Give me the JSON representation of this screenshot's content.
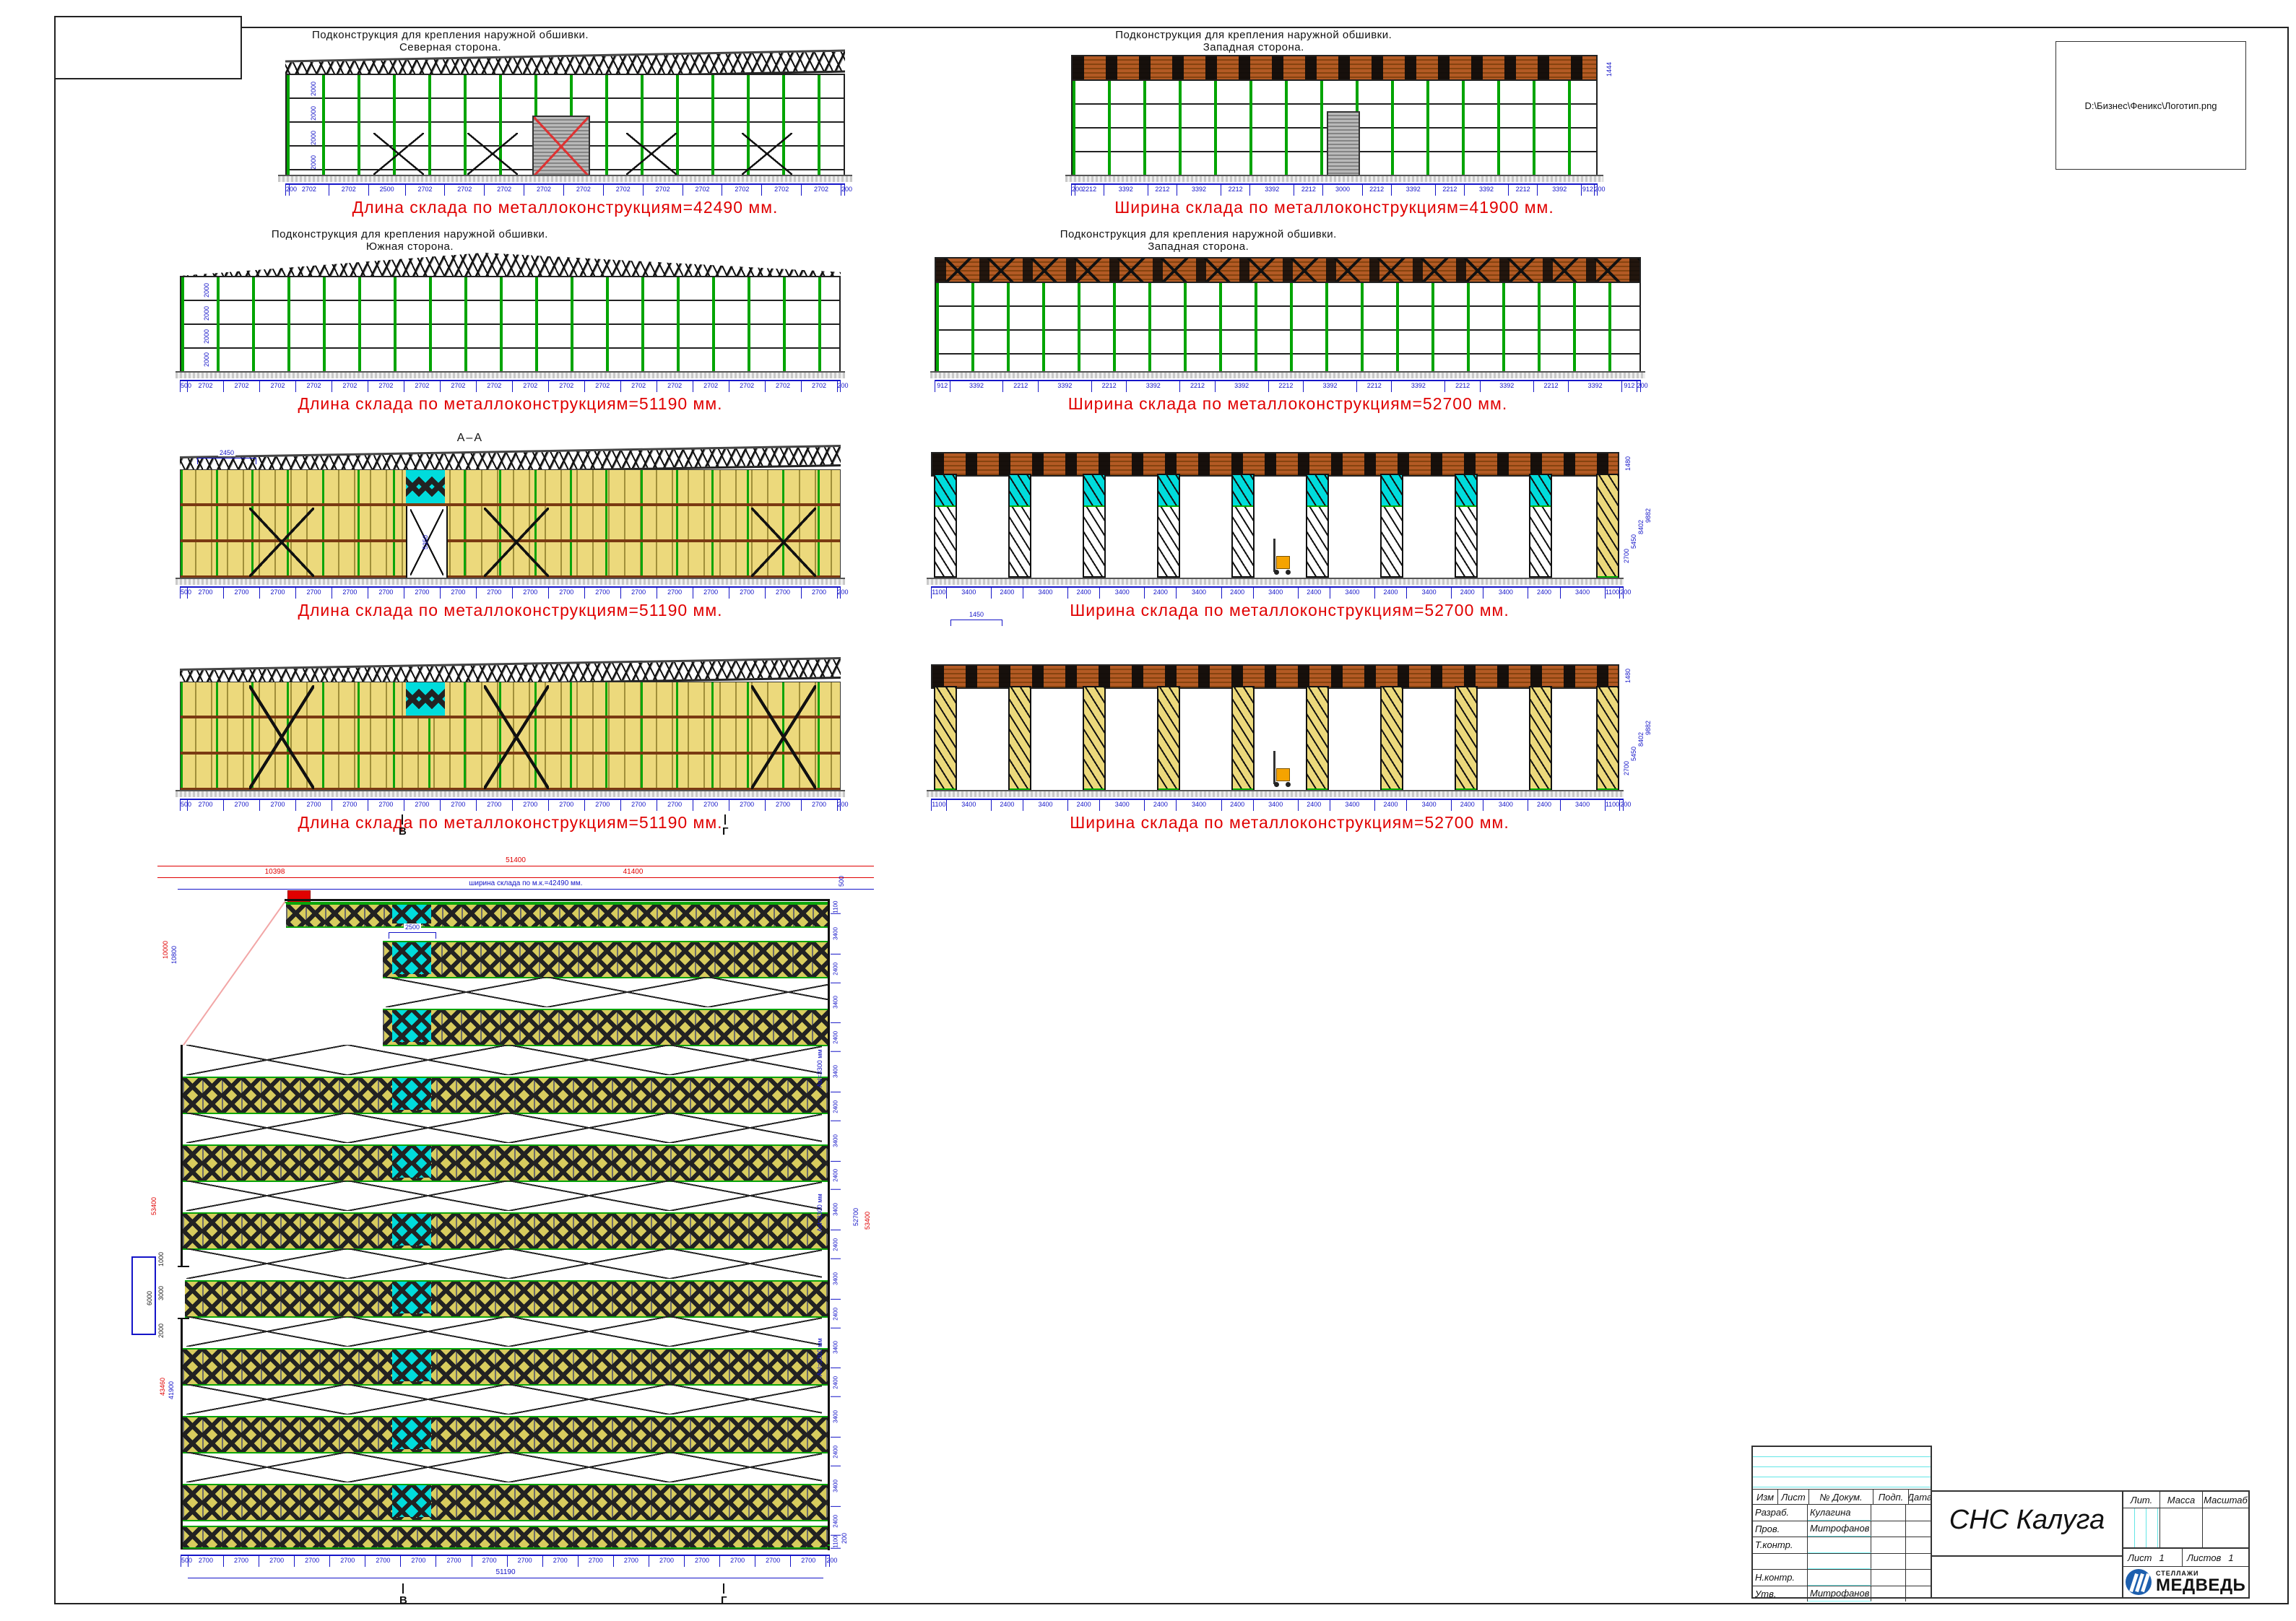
{
  "sheet": {
    "logo_path_label": "D:\\Бизнес\\Феникс\\Логотип.png"
  },
  "views": {
    "north": {
      "title1": "Подконструкция для крепления наружной обшивки.",
      "title2": "Северная сторона.",
      "total_text": "Длина склада по металлоконструкциям=42490 мм.",
      "dims": [
        "200",
        "2702",
        "2702",
        "2500",
        "2702",
        "2702",
        "2702",
        "2702",
        "2702",
        "2702",
        "2702",
        "2702",
        "2702",
        "2702",
        "2702",
        "200"
      ],
      "height_dims": [
        "2000",
        "2000",
        "2000",
        "2000"
      ]
    },
    "west_top": {
      "title1": "Подконструкция для крепления наружной обшивки.",
      "title2": "Западная сторона.",
      "total_text": "Ширина склада по металлоконструкциям=41900 мм.",
      "dims": [
        "200",
        "2212",
        "3392",
        "2212",
        "3392",
        "2212",
        "3392",
        "2212",
        "3000",
        "2212",
        "3392",
        "2212",
        "3392",
        "2212",
        "3392",
        "912",
        "200"
      ],
      "right_dim": "1444"
    },
    "south": {
      "title1": "Подконструкция для крепления наружной обшивки.",
      "title2": "Южная сторона.",
      "total_text": "Длина склада по металлоконструкциям=51190 мм.",
      "dims": [
        "500",
        "2702",
        "2702",
        "2702",
        "2702",
        "2702",
        "2702",
        "2702",
        "2702",
        "2702",
        "2702",
        "2702",
        "2702",
        "2702",
        "2702",
        "2702",
        "2702",
        "2702",
        "2702",
        "200"
      ],
      "height_dims": [
        "2000",
        "2000",
        "2000",
        "2000"
      ]
    },
    "west_mid": {
      "title1": "Подконструкция для крепления наружной обшивки.",
      "title2": "Западная сторона.",
      "total_text": "Ширина склада по металлоконструкциям=52700 мм.",
      "dims": [
        "912",
        "3392",
        "2212",
        "3392",
        "2212",
        "3392",
        "2212",
        "3392",
        "2212",
        "3392",
        "2212",
        "3392",
        "2212",
        "3392",
        "2212",
        "3392",
        "912",
        "200"
      ]
    },
    "section_long_a": {
      "label": "А–А",
      "top_dim": "2450",
      "opening_dim": "5350",
      "total_text": "Длина склада по металлоконструкциям=51190 мм.",
      "dims": [
        "500",
        "2700",
        "2700",
        "2700",
        "2700",
        "2700",
        "2700",
        "2700",
        "2700",
        "2700",
        "2700",
        "2700",
        "2700",
        "2700",
        "2700",
        "2700",
        "2700",
        "2700",
        "2700",
        "200"
      ]
    },
    "section_cross_a": {
      "total_text": "Ширина склада по металлоконструкциям=52700 мм.",
      "dims": [
        "1100",
        "3400",
        "2400",
        "3400",
        "2400",
        "3400",
        "2400",
        "3400",
        "2400",
        "3400",
        "2400",
        "3400",
        "2400",
        "3400",
        "2400",
        "3400",
        "2400",
        "3400",
        "1100",
        "200"
      ],
      "right_dims": [
        "1480",
        "9882",
        "8402",
        "5450",
        "2700"
      ]
    },
    "section_long_b": {
      "total_text": "Длина склада по металлоконструкциям=51190 мм.",
      "dims": [
        "500",
        "2700",
        "2700",
        "2700",
        "2700",
        "2700",
        "2700",
        "2700",
        "2700",
        "2700",
        "2700",
        "2700",
        "2700",
        "2700",
        "2700",
        "2700",
        "2700",
        "2700",
        "2700",
        "200"
      ],
      "mid_dim": "1450"
    },
    "section_cross_b": {
      "total_text": "Ширина склада по металлоконструкциям=52700 мм.",
      "dims": [
        "1100",
        "3400",
        "2400",
        "3400",
        "2400",
        "3400",
        "2400",
        "3400",
        "2400",
        "3400",
        "2400",
        "3400",
        "2400",
        "3400",
        "2400",
        "3400",
        "2400",
        "3400",
        "1100",
        "200"
      ],
      "right_dims": [
        "1480",
        "9882",
        "8402",
        "5450",
        "2700"
      ]
    }
  },
  "markers": {
    "b_left": "В",
    "b_right": "Г",
    "plan_left": "В",
    "plan_right": "Г"
  },
  "plan": {
    "top_total": "51400",
    "top_left": "10398",
    "top_right": "41400",
    "width_text": "ширина склада по м.к.=42490 мм.",
    "first_bay": "2500",
    "left_dims": {
      "red_a": "10000",
      "blue_a": "10800",
      "total_red": "53400",
      "red_b": "43460",
      "blue_b": "41900"
    },
    "door_dims": [
      "1000",
      "3000",
      "2000"
    ],
    "door_total": "6000",
    "right_top": "500",
    "right_bottom": "200",
    "right_chain": [
      "1100",
      "3400",
      "2400",
      "3400",
      "2400",
      "3400",
      "2400",
      "3400",
      "2400",
      "3400",
      "2400",
      "3400",
      "2400",
      "3400",
      "2400",
      "3400",
      "2400",
      "3400",
      "2400",
      "1100"
    ],
    "right_total_blue": "52700",
    "right_total_red": "53400",
    "aisle_label": "Asl=3300 мм",
    "bottom_dims": [
      "500",
      "2700",
      "2700",
      "2700",
      "2700",
      "2700",
      "2700",
      "2700",
      "2700",
      "2700",
      "2700",
      "2700",
      "2700",
      "2700",
      "2700",
      "2700",
      "2700",
      "2700",
      "2700",
      "200"
    ],
    "bottom_total": "51190"
  },
  "titleblock": {
    "header_cols": [
      "Изм",
      "Лист",
      "№ Докум.",
      "Подп.",
      "Дата"
    ],
    "rows": [
      {
        "label": "Разраб.",
        "name": "Кулагина"
      },
      {
        "label": "Пров.",
        "name": "Митрофанов"
      },
      {
        "label": "Т.контр.",
        "name": ""
      },
      {
        "label": "",
        "name": ""
      },
      {
        "label": "Н.контр.",
        "name": ""
      },
      {
        "label": "Утв.",
        "name": "Митрофанов"
      }
    ],
    "doc_title": "СНС Калуга",
    "lit": "Лит.",
    "mass": "Масса",
    "scale": "Масштаб",
    "sheet": "Лист",
    "sheet_no": "1",
    "sheets": "Листов",
    "sheets_no": "1",
    "logo_small": "СТЕЛЛАЖИ",
    "logo_big": "МЕДВЕДЬ"
  }
}
